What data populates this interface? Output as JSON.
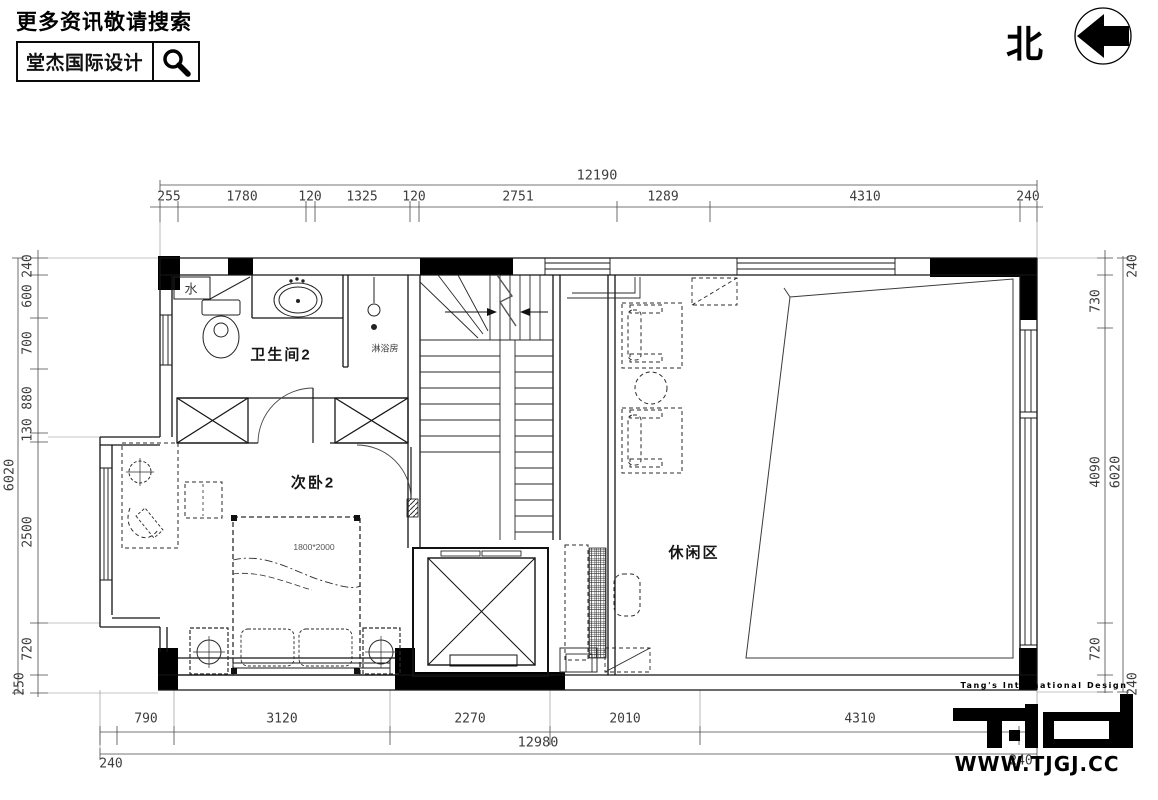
{
  "banner": {
    "prompt": "更多资讯敬请搜索",
    "brand": "堂杰国际设计"
  },
  "compass": {
    "north": "北"
  },
  "rooms": {
    "bathroom": "卫生间2",
    "bedroom": "次卧2",
    "leisure": "休闲区"
  },
  "labels": {
    "water": "水",
    "shower": "淋浴房",
    "bed_size": "1800*2000"
  },
  "dims": {
    "top": {
      "total": "12190",
      "segments": [
        "255",
        "1780",
        "120",
        "1325",
        "120",
        "2751",
        "1289",
        "4310",
        "240"
      ]
    },
    "bottom": {
      "total": "12980",
      "left_240": "240",
      "right_240": "240",
      "segments": [
        "790",
        "3120",
        "2270",
        "2010",
        "4310"
      ]
    },
    "left": {
      "total": "6020",
      "segments": [
        "240",
        "600",
        "700",
        "880",
        "130",
        "2500",
        "720",
        "250"
      ]
    },
    "right": {
      "total": "6020",
      "segments": [
        "240",
        "730",
        "4090",
        "720",
        "240"
      ]
    }
  },
  "brandmark": {
    "tagline": "Tang's International Design",
    "site": "WWW.TJGJ.CC"
  },
  "colors": {
    "ink": "#111111",
    "dim_text": "#3d3d3d"
  }
}
